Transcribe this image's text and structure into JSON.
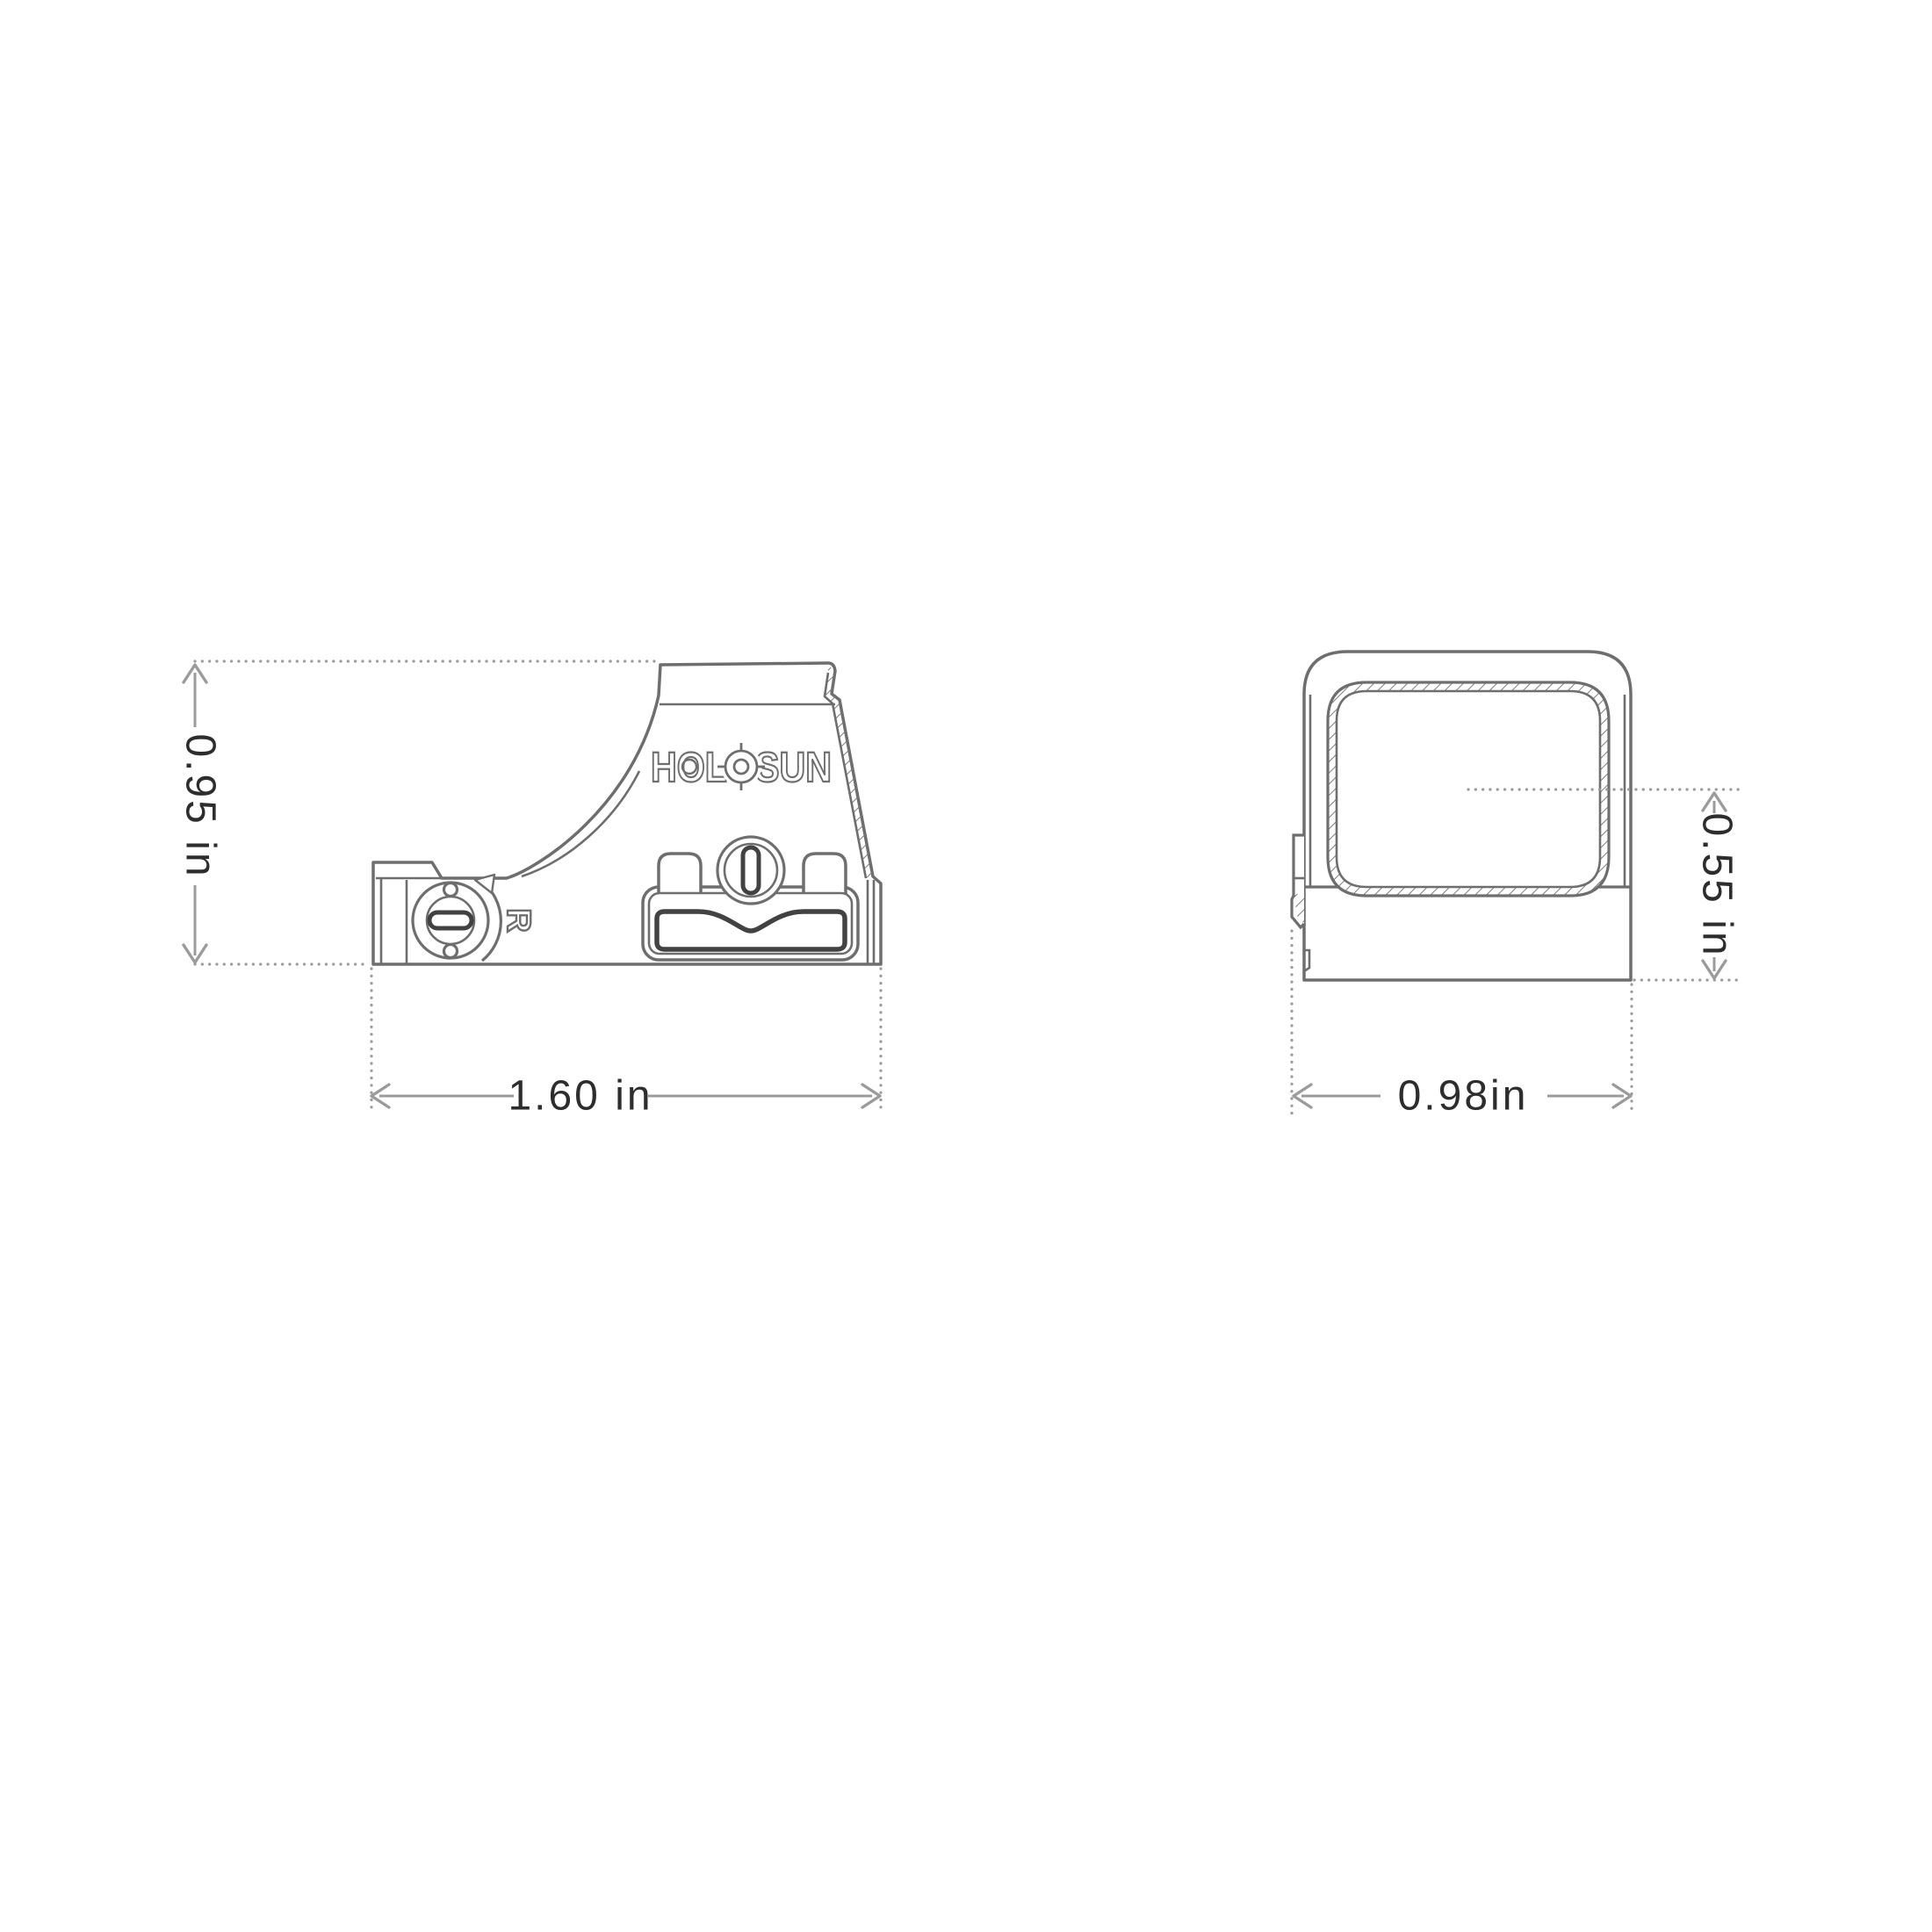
{
  "drawing": {
    "title": "reflex-sight dimensional drawing",
    "brand": "HOLOSUN",
    "views": {
      "side": {
        "height_label": "0.95 in",
        "width_label": "1.60 in",
        "dial_marking": "R"
      },
      "front": {
        "width_label": "0.98in",
        "center_height_label": "0.55 in"
      }
    },
    "colors": {
      "line": "#6e6e6e",
      "dim": "#9b9b9b",
      "dark": "#424242",
      "text": "#2d2d2d",
      "bg": "#ffffff"
    }
  }
}
